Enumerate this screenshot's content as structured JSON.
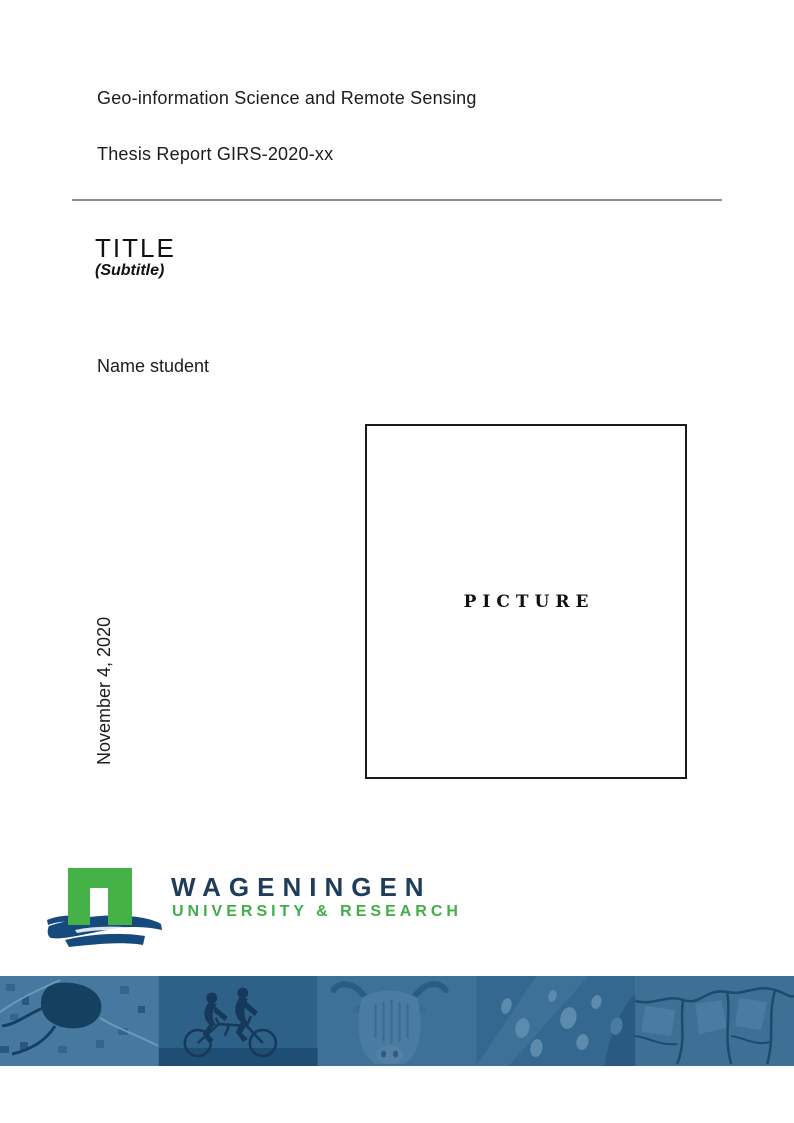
{
  "header": {
    "department": "Geo-information Science and Remote Sensing",
    "report_id": "Thesis Report GIRS-2020-xx"
  },
  "body": {
    "title": "TITLE",
    "subtitle": "(Subtitle)",
    "author": "Name student",
    "date": "November 4, 2020",
    "picture_label": "PICTURE"
  },
  "logo": {
    "name": "WAGENINGEN",
    "tagline": "UNIVERSITY & RESEARCH",
    "colors": {
      "green": "#45b247",
      "navy": "#1e3d5b",
      "swoosh_blue": "#174a7c"
    }
  },
  "banner": {
    "overlay_color": "#38698f",
    "images": [
      "aerial-farmland",
      "tandem-cyclists",
      "highland-cow",
      "butterfly-wing",
      "cracked-earth"
    ]
  }
}
